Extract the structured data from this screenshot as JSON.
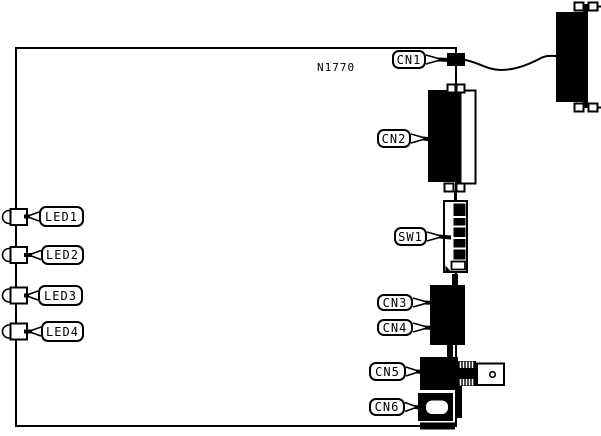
{
  "part_number": "N1770",
  "callouts": {
    "cn1": "CN1",
    "cn2": "CN2",
    "sw1": "SW1",
    "cn3": "CN3",
    "cn4": "CN4",
    "cn5": "CN5",
    "cn6": "CN6",
    "led1": "LED1",
    "led2": "LED2",
    "led3": "LED3",
    "led4": "LED4"
  },
  "colors": {
    "ink": "#000000",
    "paper": "#ffffff"
  }
}
